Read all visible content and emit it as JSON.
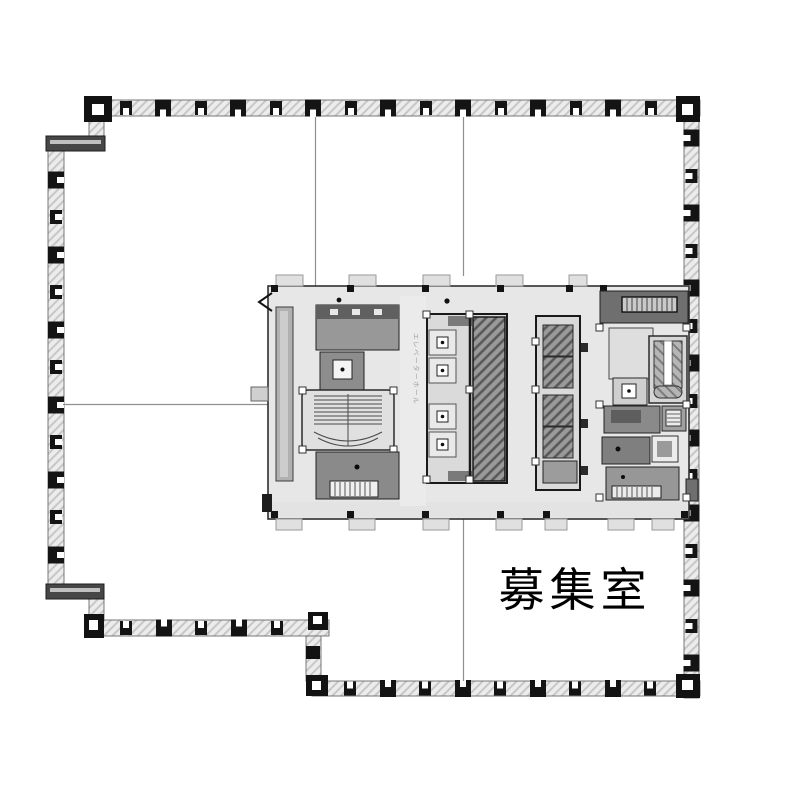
{
  "room_label": {
    "text": "募集室"
  },
  "corridor_label": {
    "text": "エレベーターホール"
  },
  "colors": {
    "ink": "#141414",
    "wall_band": "#ececec",
    "core_fill": "#e7e7e7",
    "dark_room": "#8f8f8f",
    "shaft_hatch": "#9a9a9a",
    "background": "#ffffff"
  }
}
